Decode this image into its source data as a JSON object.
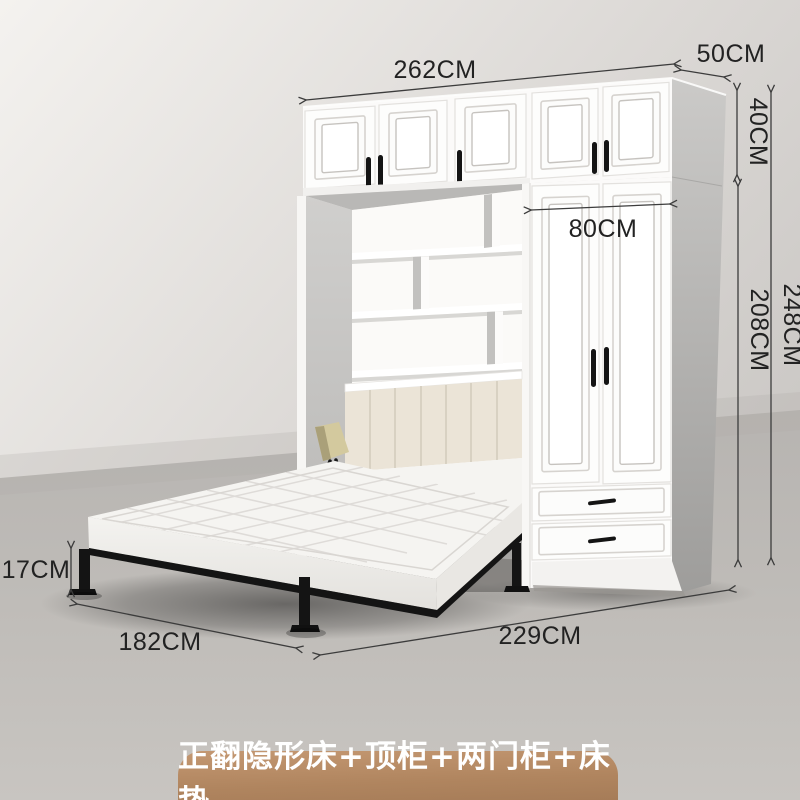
{
  "banner": {
    "label": "正翻隐形床+顶柜+两门柜+床垫",
    "background_top": "#c49872",
    "background_bottom": "#a67c58",
    "text_color": "#ffffff"
  },
  "dimensions": {
    "cabinet_total_width": "262CM",
    "cabinet_depth": "50CM",
    "top_cabinet_height": "40CM",
    "total_height": "248CM",
    "wardrobe_body_height": "208CM",
    "wardrobe_width": "80CM",
    "bed_frame_height": "17CM",
    "bed_width": "182CM",
    "bed_floor_length": "229CM"
  },
  "colors": {
    "annotation_line": "#3c3c3c",
    "annotation_text": "#222222",
    "furniture_white": "#fdfdfc",
    "wall_light": "#f3f1ee",
    "wall_shade": "#c8c5c2",
    "floor": "#c2bfbb",
    "mattress_white": "#f5f4f1",
    "headboard_cream": "#ebe4d7",
    "metal_frame_black": "#141414",
    "lamp_shade": "#d3c99e"
  }
}
